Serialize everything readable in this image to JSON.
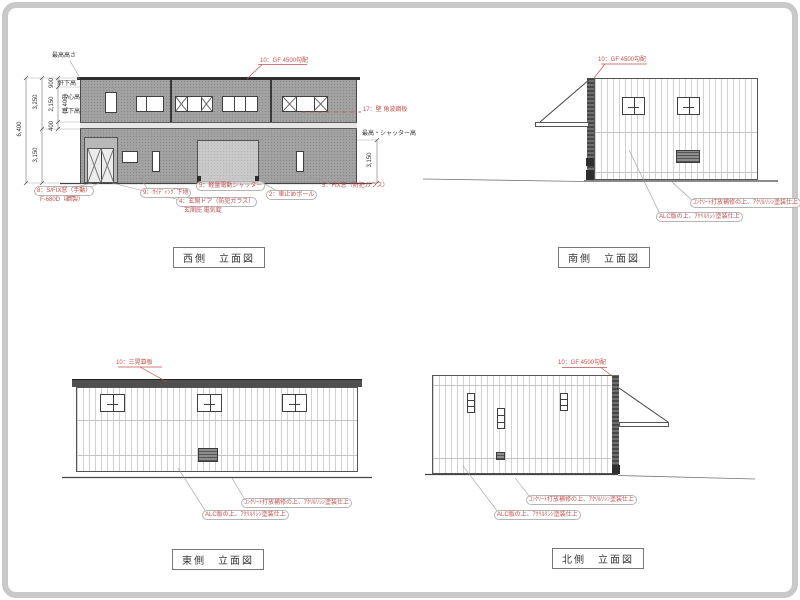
{
  "colors": {
    "annotation_red": "#c0504d",
    "facade_gray": "#a2a2a2",
    "line_gray": "#555555"
  },
  "views": {
    "west": {
      "title": "西側　立面図",
      "roof_note": "10：GF 4500勾配",
      "wall_note": "17：壁 角波鋼板",
      "labels": {
        "slit_window_1": "8：S/FIX窓（手動）",
        "slit_window_2": "F-680D（鋼製）",
        "siding": "9：ｻｲﾃﾞｨﾝｸﾞ下地",
        "entrance_1": "4：玄関ドア（防犯ガラス）",
        "entrance_2": "玄関庇 電気錠",
        "shutter": "5：軽量電動シャッター",
        "pole": "2：車止めポール",
        "fix_window": "5：FIX窓（防犯ガラス）"
      },
      "dims": {
        "overall": "6,400",
        "upper": "3,250",
        "lower": "3,150",
        "parapet": "900",
        "window_band": "2,150",
        "window_inner": "(1,400)",
        "sill": "400",
        "shutter_height": "3,150"
      },
      "dim_labels": {
        "max_height": "最高高さ",
        "eave": "軒下高",
        "center": "中心高",
        "sill": "窓下高",
        "shutter_max": "最高・シャッター高"
      }
    },
    "south": {
      "title": "南側　立面図",
      "roof_note": "10：GF 4500勾配",
      "finish_concrete": "ｺﾝｸﾘｰﾄ打放補修の上、ｱｸﾘﾙﾘｼﾝ塗装仕上",
      "finish_alc": "ALC版の上、ｱｸﾘﾙﾘｼﾝ塗装仕上"
    },
    "east": {
      "title": "東側　立面図",
      "roof_note": "10：三晃葺板",
      "finish_concrete": "ｺﾝｸﾘｰﾄ打放補修の上、ｱｸﾘﾙﾘｼﾝ塗装仕上",
      "finish_alc": "ALC版の上、ｱｸﾘﾙﾘｼﾝ塗装仕上"
    },
    "north": {
      "title": "北側　立面図",
      "roof_note": "10：GF 4500勾配",
      "finish_concrete": "ｺﾝｸﾘｰﾄ打放補修の上、ｱｸﾘﾙﾘｼﾝ塗装仕上",
      "finish_alc": "ALC版の上、ｱｸﾘﾙﾘｼﾝ塗装仕上"
    }
  }
}
